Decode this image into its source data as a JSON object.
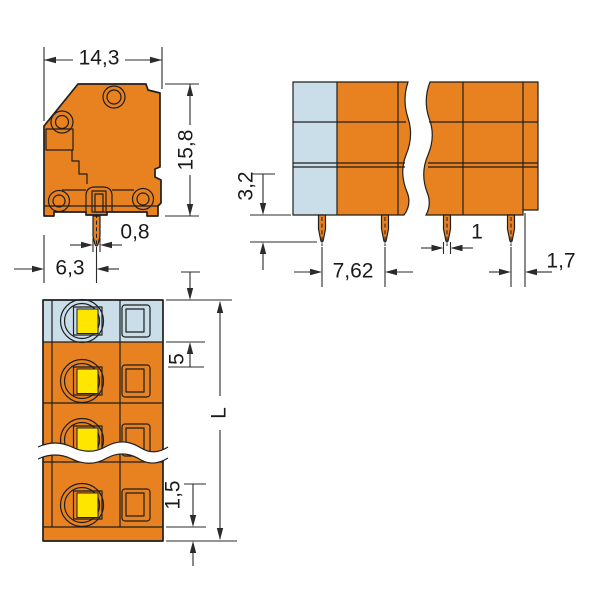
{
  "colors": {
    "body_orange": "#E8811F",
    "end_section_blue": "#C9DEE9",
    "screw_yellow": "#FFE600",
    "line_dark": "#1F1F1F",
    "background": "#FFFFFF"
  },
  "views": {
    "side": {
      "dims": {
        "overall_width": "14,3",
        "overall_height": "15,8",
        "pin_width": "0,8",
        "pin_offset": "6,3"
      }
    },
    "front": {
      "dims": {
        "pin_length": "3,2",
        "pitch": "7,62",
        "pin_width": "1",
        "end_offset": "1,7"
      }
    },
    "top": {
      "dims": {
        "first_division": "5",
        "length": "L",
        "end_wall": "1,5"
      }
    }
  }
}
